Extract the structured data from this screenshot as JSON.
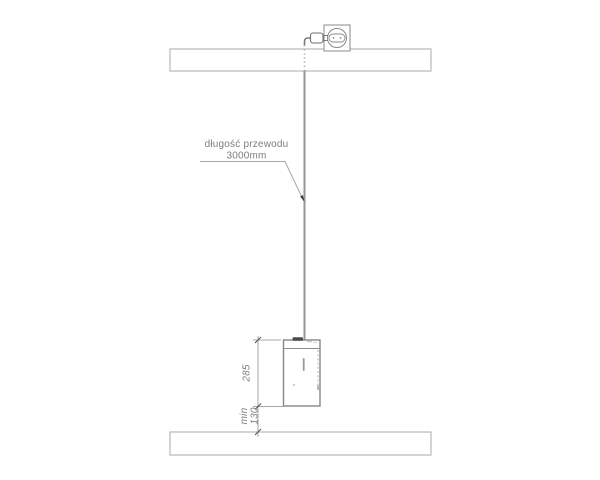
{
  "drawing": {
    "cable_label": {
      "line1": "długość przewodu",
      "line2": "3000mm"
    },
    "dimensions": {
      "lamp_height": "285",
      "min_label": "min",
      "floor_clearance": "130"
    },
    "colors": {
      "line": "#a8a8a8",
      "outline": "#8a8a8a",
      "cable": "#969696",
      "text": "#7d7d7d",
      "dark_detail": "#4a4a4a"
    }
  }
}
